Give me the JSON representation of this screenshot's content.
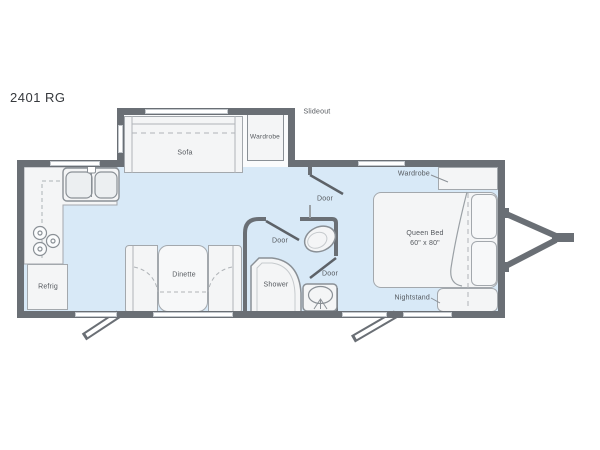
{
  "title": "2401 RG",
  "colors": {
    "wall": "#6a6f75",
    "floor": "#d8e9f7",
    "furniture_fill": "#f4f5f6",
    "furniture_border": "#a3a8ad",
    "fixture_border": "#8a9096",
    "label_text": "#54585d",
    "title_text": "#36393d",
    "window_fill": "#ffffff"
  },
  "labels": {
    "slideout": "Slideout",
    "sofa": "Sofa",
    "wardrobe_slideout": "Wardrobe",
    "wardrobe_bedroom": "Wardrobe",
    "door_bedroom": "Door",
    "door_bathroom": "Door",
    "door_bath_to_bedroom": "Door",
    "shower": "Shower",
    "dinette": "Dinette",
    "refrig": "Refrig",
    "queen_bed": "Queen Bed",
    "queen_bed_size": "60\" x 80\"",
    "nightstand": "Nightstand"
  }
}
